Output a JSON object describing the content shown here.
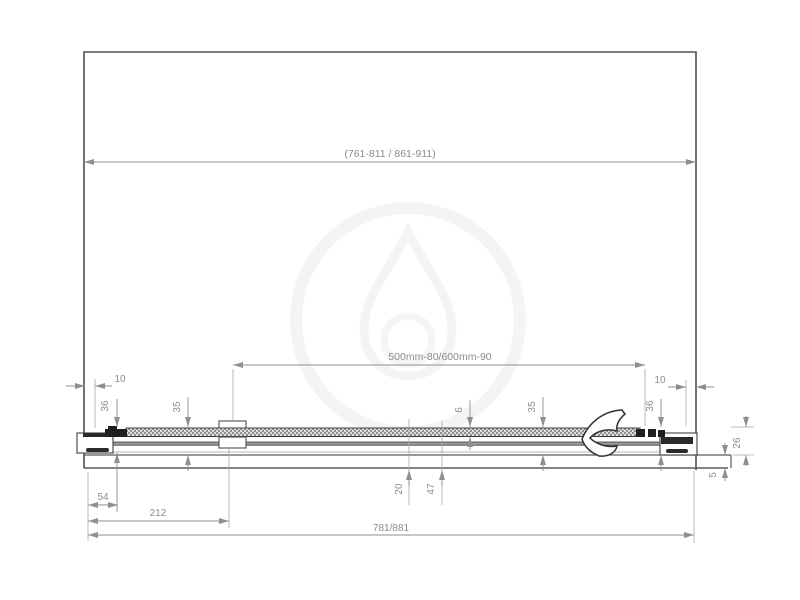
{
  "drawing": {
    "title": "shower-door-section-drawing",
    "watermark_icon": "water-drop-logo-watermark",
    "dims": {
      "opening_width": "(761-811 / 861-911)",
      "glass_width": "500mm-80/600mm-90",
      "left_wall_gap": "10",
      "right_wall_gap": "10",
      "left_profile_height": "36",
      "left_rail_height": "35",
      "glass_thickness": "6",
      "right_rail_height": "35",
      "right_profile_height": "36",
      "section_height": "26",
      "bottom_clearance": "5",
      "profile_width": "54",
      "bracket_offset": "212",
      "door_width": "781/881",
      "threshold_inner": "20",
      "threshold_outer": "47"
    },
    "colors": {
      "outline": "#4f4f4f",
      "hardware": "#1f1f1f",
      "dim_line": "#8f8f8f",
      "dim_text": "#8c8c8c",
      "glass_fill": "#d9d9d9"
    }
  }
}
